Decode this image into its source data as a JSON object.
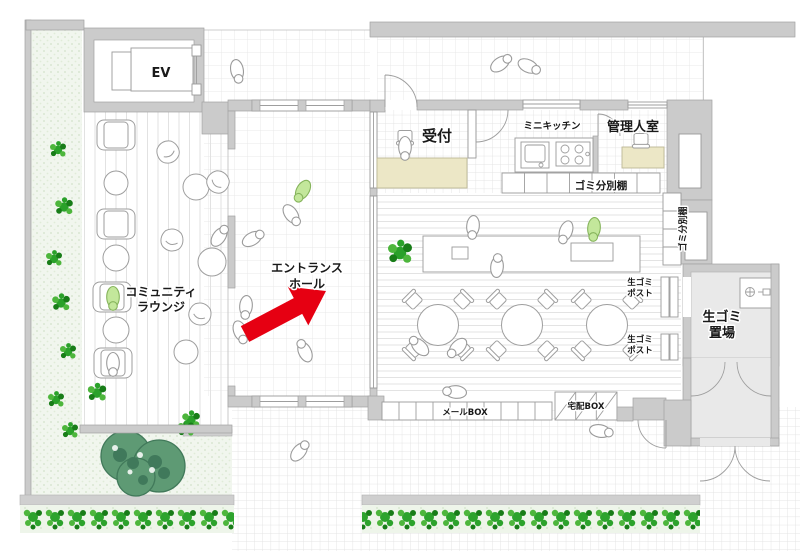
{
  "floor_plan": {
    "labels": {
      "elevator": "EV",
      "reception": "受付",
      "mini_kitchen": "ミニキッチン",
      "manager_room": "管理人室",
      "garbage_sorting_shelf": "ゴミ分別棚",
      "garbage_sorting_shelf_side": "ゴミ分別棚",
      "community_lounge": [
        "コミュニティ",
        "ラウンジ"
      ],
      "entrance_hall": [
        "エントランス",
        "ホール"
      ],
      "raw_garbage_post_upper": [
        "生ゴミ",
        "ポスト"
      ],
      "raw_garbage_post_lower": [
        "生ゴミ",
        "ポスト"
      ],
      "raw_garbage_storage": [
        "生ゴミ",
        "置場"
      ],
      "mail_box": "メールBOX",
      "delivery_box": "宅配BOX"
    },
    "colors": {
      "wall_gray": "#cbcbcb",
      "counter_beige": "#ece7c6",
      "arrow_red": "#e60012",
      "person_green": "#c3e79b",
      "plant_green": "#2da32d",
      "tree_green": "#5e9a74",
      "garden_background": "#f1f6ee"
    }
  }
}
